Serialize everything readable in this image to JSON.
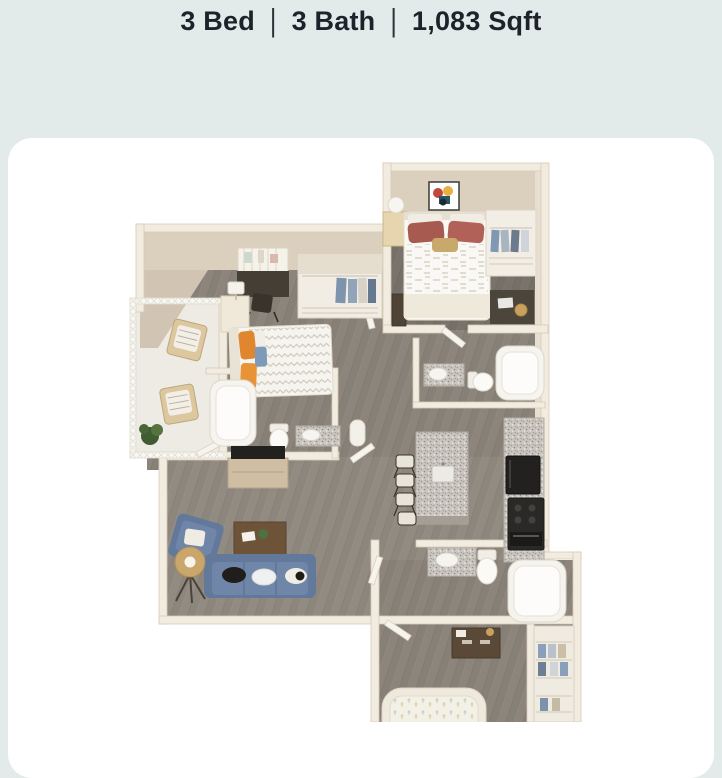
{
  "header": {
    "stats": [
      {
        "label": "3 Bed"
      },
      {
        "label": "3 Bath"
      },
      {
        "label": "1,083 Sqft"
      }
    ],
    "separator": "|",
    "text_color": "#1c232a"
  },
  "card": {
    "background": "#ffffff",
    "corner_radius_px": 24
  },
  "floor_plan": {
    "type": "3d-isometric-floorplan-render",
    "beds": "3",
    "baths": "3",
    "sqft": "1,083",
    "rooms": [
      {
        "name": "bedroom-1",
        "position": "top-right",
        "features": [
          "bed",
          "wall-art",
          "nightstand",
          "lamp",
          "wire-closet",
          "desk"
        ]
      },
      {
        "name": "bedroom-2",
        "position": "middle-left",
        "features": [
          "bed",
          "nightstand",
          "lamp",
          "desk",
          "chair",
          "wall-shelf",
          "closet"
        ]
      },
      {
        "name": "bedroom-3",
        "position": "bottom",
        "features": [
          "bed",
          "dresser",
          "wire-closet"
        ]
      },
      {
        "name": "bathroom-1",
        "position": "center",
        "features": [
          "bathtub",
          "toilet",
          "granite-vanity"
        ]
      },
      {
        "name": "bathroom-2",
        "position": "center-right",
        "features": [
          "bathtub",
          "toilet",
          "granite-vanity"
        ]
      },
      {
        "name": "bathroom-3",
        "position": "bottom-center",
        "features": [
          "bathtub",
          "toilet",
          "granite-vanity"
        ]
      },
      {
        "name": "living-room",
        "position": "bottom-left",
        "features": [
          "sofa",
          "armchair",
          "coffee-table",
          "floor-lamp",
          "tv-console",
          "tv"
        ]
      },
      {
        "name": "kitchen",
        "position": "center-right",
        "features": [
          "granite-island",
          "bar-stools",
          "granite-counter",
          "refrigerator",
          "stove"
        ]
      },
      {
        "name": "patio",
        "position": "left",
        "features": [
          "lounge-chair",
          "lounge-chair",
          "plant",
          "lattice-wall"
        ]
      }
    ],
    "palette": {
      "page_background": "#e3eaea",
      "card_background": "#ffffff",
      "wall_cream": "#f2ebdf",
      "wall_face_beige": "#dbcfbe",
      "wall_shadow": "#d2c4b2",
      "floor_wood": "#8d857c",
      "floor_wood_dark": "#766f68",
      "patio_tile": "#edebe4",
      "sofa_blue": "#6c83a5",
      "pillow_orange": "#e0862e",
      "pillow_maroon": "#a75a50",
      "granite_speckle": "#cbc7c0",
      "appliance_black": "#24221f",
      "furniture_wood": "#6d5439",
      "plant_green": "#4e6b3f"
    }
  }
}
